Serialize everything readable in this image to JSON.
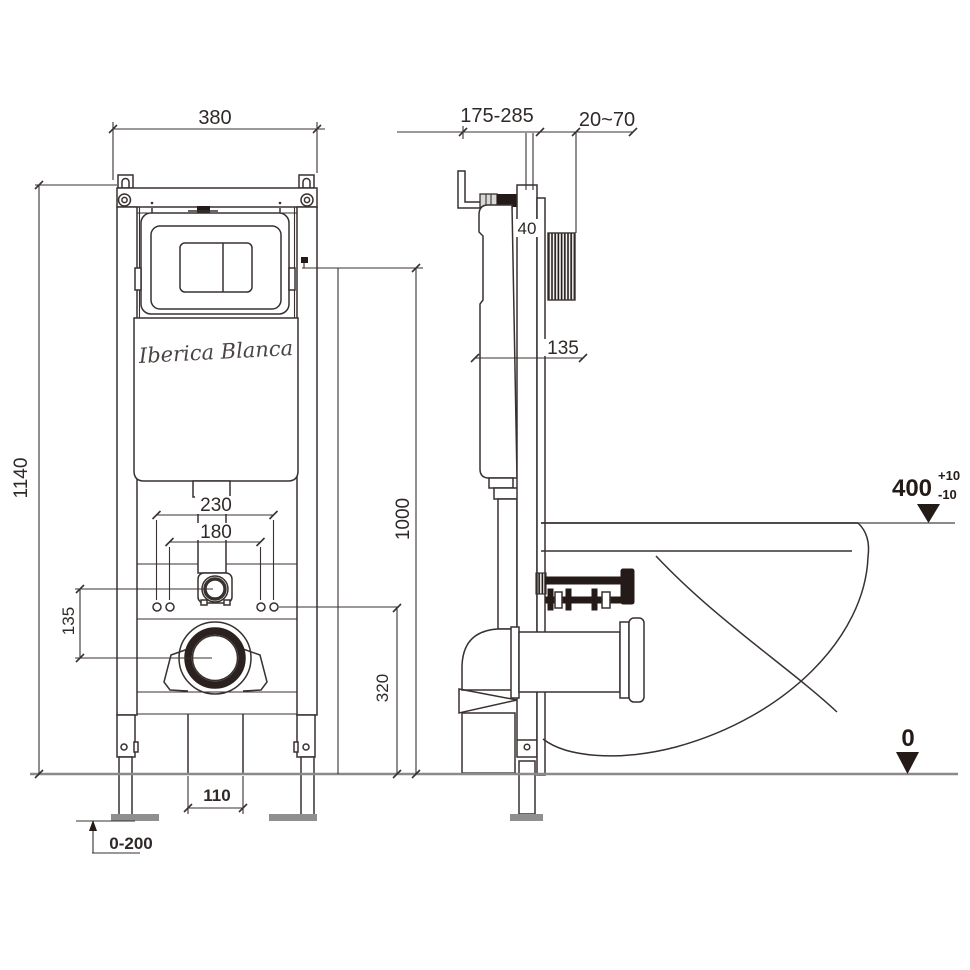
{
  "drawing": {
    "product": "wall-hung toilet concealed cistern installation frame",
    "views": [
      "front elevation",
      "side section with bowl"
    ],
    "brand": "Iberica Blanca"
  },
  "labels": {
    "logo": "Iberica Blanca",
    "dim_380": "380",
    "dim_1140": "1140",
    "dim_230": "230",
    "dim_180": "180",
    "dim_135_front": "135",
    "dim_1000": "1000",
    "dim_320": "320",
    "dim_110": "110",
    "dim_0_200": "0-200",
    "dim_175_285": "175-285",
    "dim_20_70": "20~70",
    "dim_40": "40",
    "dim_135_side": "135",
    "datum_400": "400",
    "datum_400_plus": "+10",
    "datum_400_minus": "-10",
    "datum_0": "0"
  }
}
